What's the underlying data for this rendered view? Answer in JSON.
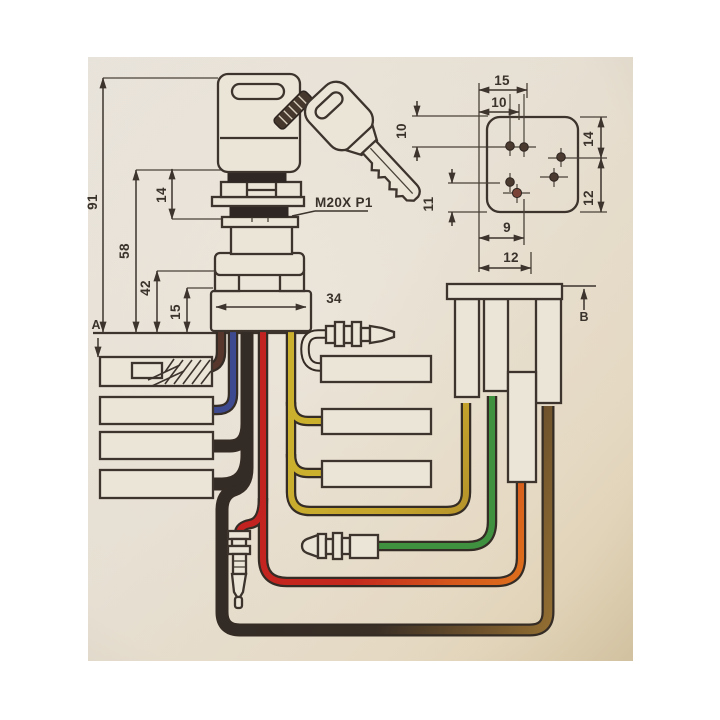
{
  "drawing": {
    "thread_label": "M20X P1",
    "section_a": "A",
    "section_b": "B",
    "front_dims": {
      "overall_height": "91",
      "upper_height": "58",
      "lower_height": "42",
      "thread_section": "14",
      "base_height": "15",
      "base_width": "34"
    },
    "rear_dims": {
      "top_width": "15",
      "top_inner": "10",
      "left_top": "10",
      "left_bottom": "11",
      "right_top": "14",
      "right_bottom": "12",
      "bottom_inner": "9",
      "bottom_width": "12"
    },
    "colors": {
      "paper": "#ebe5d8",
      "ink": "#3c342d",
      "wire_brown": "#57362c",
      "wire_blue": "#3d4a8f",
      "wire_black": "#332b26",
      "wire_red": "#c32320",
      "wire_yellow": "#c9ad2f",
      "wire_green": "#3f9140",
      "glare_orange": "#e2791d"
    }
  }
}
